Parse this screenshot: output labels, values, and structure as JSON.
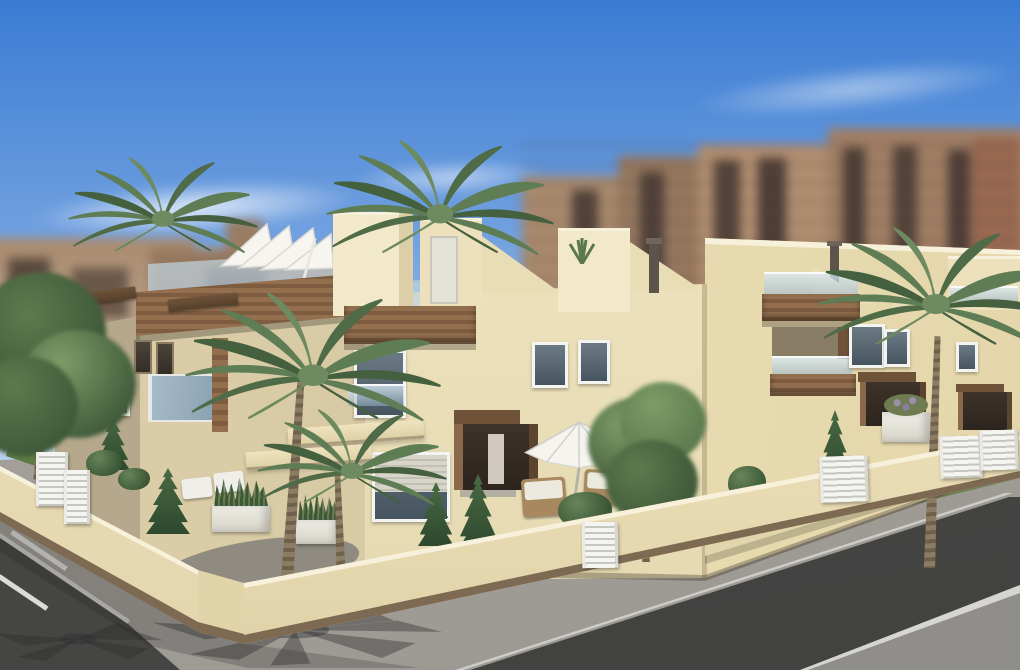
{
  "scene": {
    "type": "3d-architectural-exterior-render",
    "subject": "New-build row of modern two-storey cream townhouses with stepped roof terraces, seen from a street corner",
    "setting": "Blurred tan high-rise apartment blocks in the background under a clear blue sky; corner plot enclosed by a low cream wall with white louvered fence sections; palm trees, conifers and shrubs in the garden; asphalt road, sidewalks and parking lines in the foreground",
    "time_of_day": "day"
  },
  "palette": {
    "sky_top": "#3a7cd3",
    "sky_mid": "#6f9fdf",
    "sky_low": "#b9d3ef",
    "sky_horizon": "#ddeaf7",
    "cloud": "#ffffff",
    "bg_tan": "#a98a6e",
    "bg_tan2": "#96785f",
    "bg_dark": "#504036",
    "bg_red": "#9a6952",
    "bg_light": "#cbbfae",
    "cream_lit": "#ece1bc",
    "cream_light": "#f2e8ca",
    "cream_pale": "#f7f0da",
    "cream_shade": "#d9cba4",
    "tan_shadow": "#b5a88c",
    "tan_mid": "#d6c8a2",
    "wood": "#8a684a",
    "wood_dark": "#6f5339",
    "wood_deep": "#5c452f",
    "door_dark": "#3a2f26",
    "glass": "#a9bdca",
    "glass_dark": "#55646e",
    "frame_white": "#f4f4f0",
    "shutter": "#d7d4ca",
    "wall_cream": "#ecdfb8",
    "wall_shade": "#e0d2a7",
    "wall_trim": "#7e6a52",
    "fence": "#f4f4f1",
    "fence_line": "#c6c6c0",
    "sidewalk": "#a3a09a",
    "sidewalk_dark": "#8f8e8a",
    "road": "#474745",
    "curb": "#cdccc8",
    "line_white": "#dcdbd7",
    "shadow": "#2f2f2f",
    "grass": "#5c7a42",
    "leaf_dark": "#3d5737",
    "leaf_mid": "#5c7a4e",
    "leaf_light": "#7d9c68",
    "palm_a": "#4f6b47",
    "palm_b": "#5f7d55",
    "palm_c": "#44603e",
    "palm_d": "#6e8a60",
    "trunk": "#8d7c64",
    "trunk_dark": "#6f604c",
    "white_furn": "#f0efe9",
    "wicker": "#a8885f",
    "chim": "#5c544a"
  },
  "elements": [
    {
      "name": "sky",
      "description": "Clear blue gradient sky with thin white clouds"
    },
    {
      "name": "background-city",
      "description": "Out-of-focus tan and reddish apartment towers with dark balcony bands"
    },
    {
      "name": "townhouse-row",
      "description": "Cream stucco terraced houses meeting at a corner, sunlit right faces"
    },
    {
      "name": "roof-terraces",
      "description": "Roof decks with glass railings, stair bulkheads, sloped parapets, white sofa and folded parasol"
    },
    {
      "name": "balcony-canopies",
      "description": "Dark wood fascia boxes over balconies and entrances"
    },
    {
      "name": "windows",
      "description": "White-framed windows, one with roller shutter half closed, Juliet glass balustrades"
    },
    {
      "name": "entrances",
      "description": "Recessed front doors with wide wood surrounds"
    },
    {
      "name": "perimeter-wall",
      "description": "Low cream garden wall with brown base trim and white louvered fence and gate sections"
    },
    {
      "name": "garden",
      "description": "Courtyard with palms, conifers, round shrubs, white planter boxes and grass strips"
    },
    {
      "name": "patio",
      "description": "Front patio with open white parasol, two wicker armchairs and shrubs; sun loungers on left terrace"
    },
    {
      "name": "palm-trees",
      "description": "Five palms, two rising above the roofline and one tall palm on the right"
    },
    {
      "name": "street",
      "description": "Dark asphalt road crossing the foreground with light gray sidewalks and curb lines"
    },
    {
      "name": "parking-area",
      "description": "Asphalt strip at lower left with white parking stall lines"
    },
    {
      "name": "palm-shadows",
      "description": "Palm frond shadows cast on the corner sidewalk"
    }
  ]
}
